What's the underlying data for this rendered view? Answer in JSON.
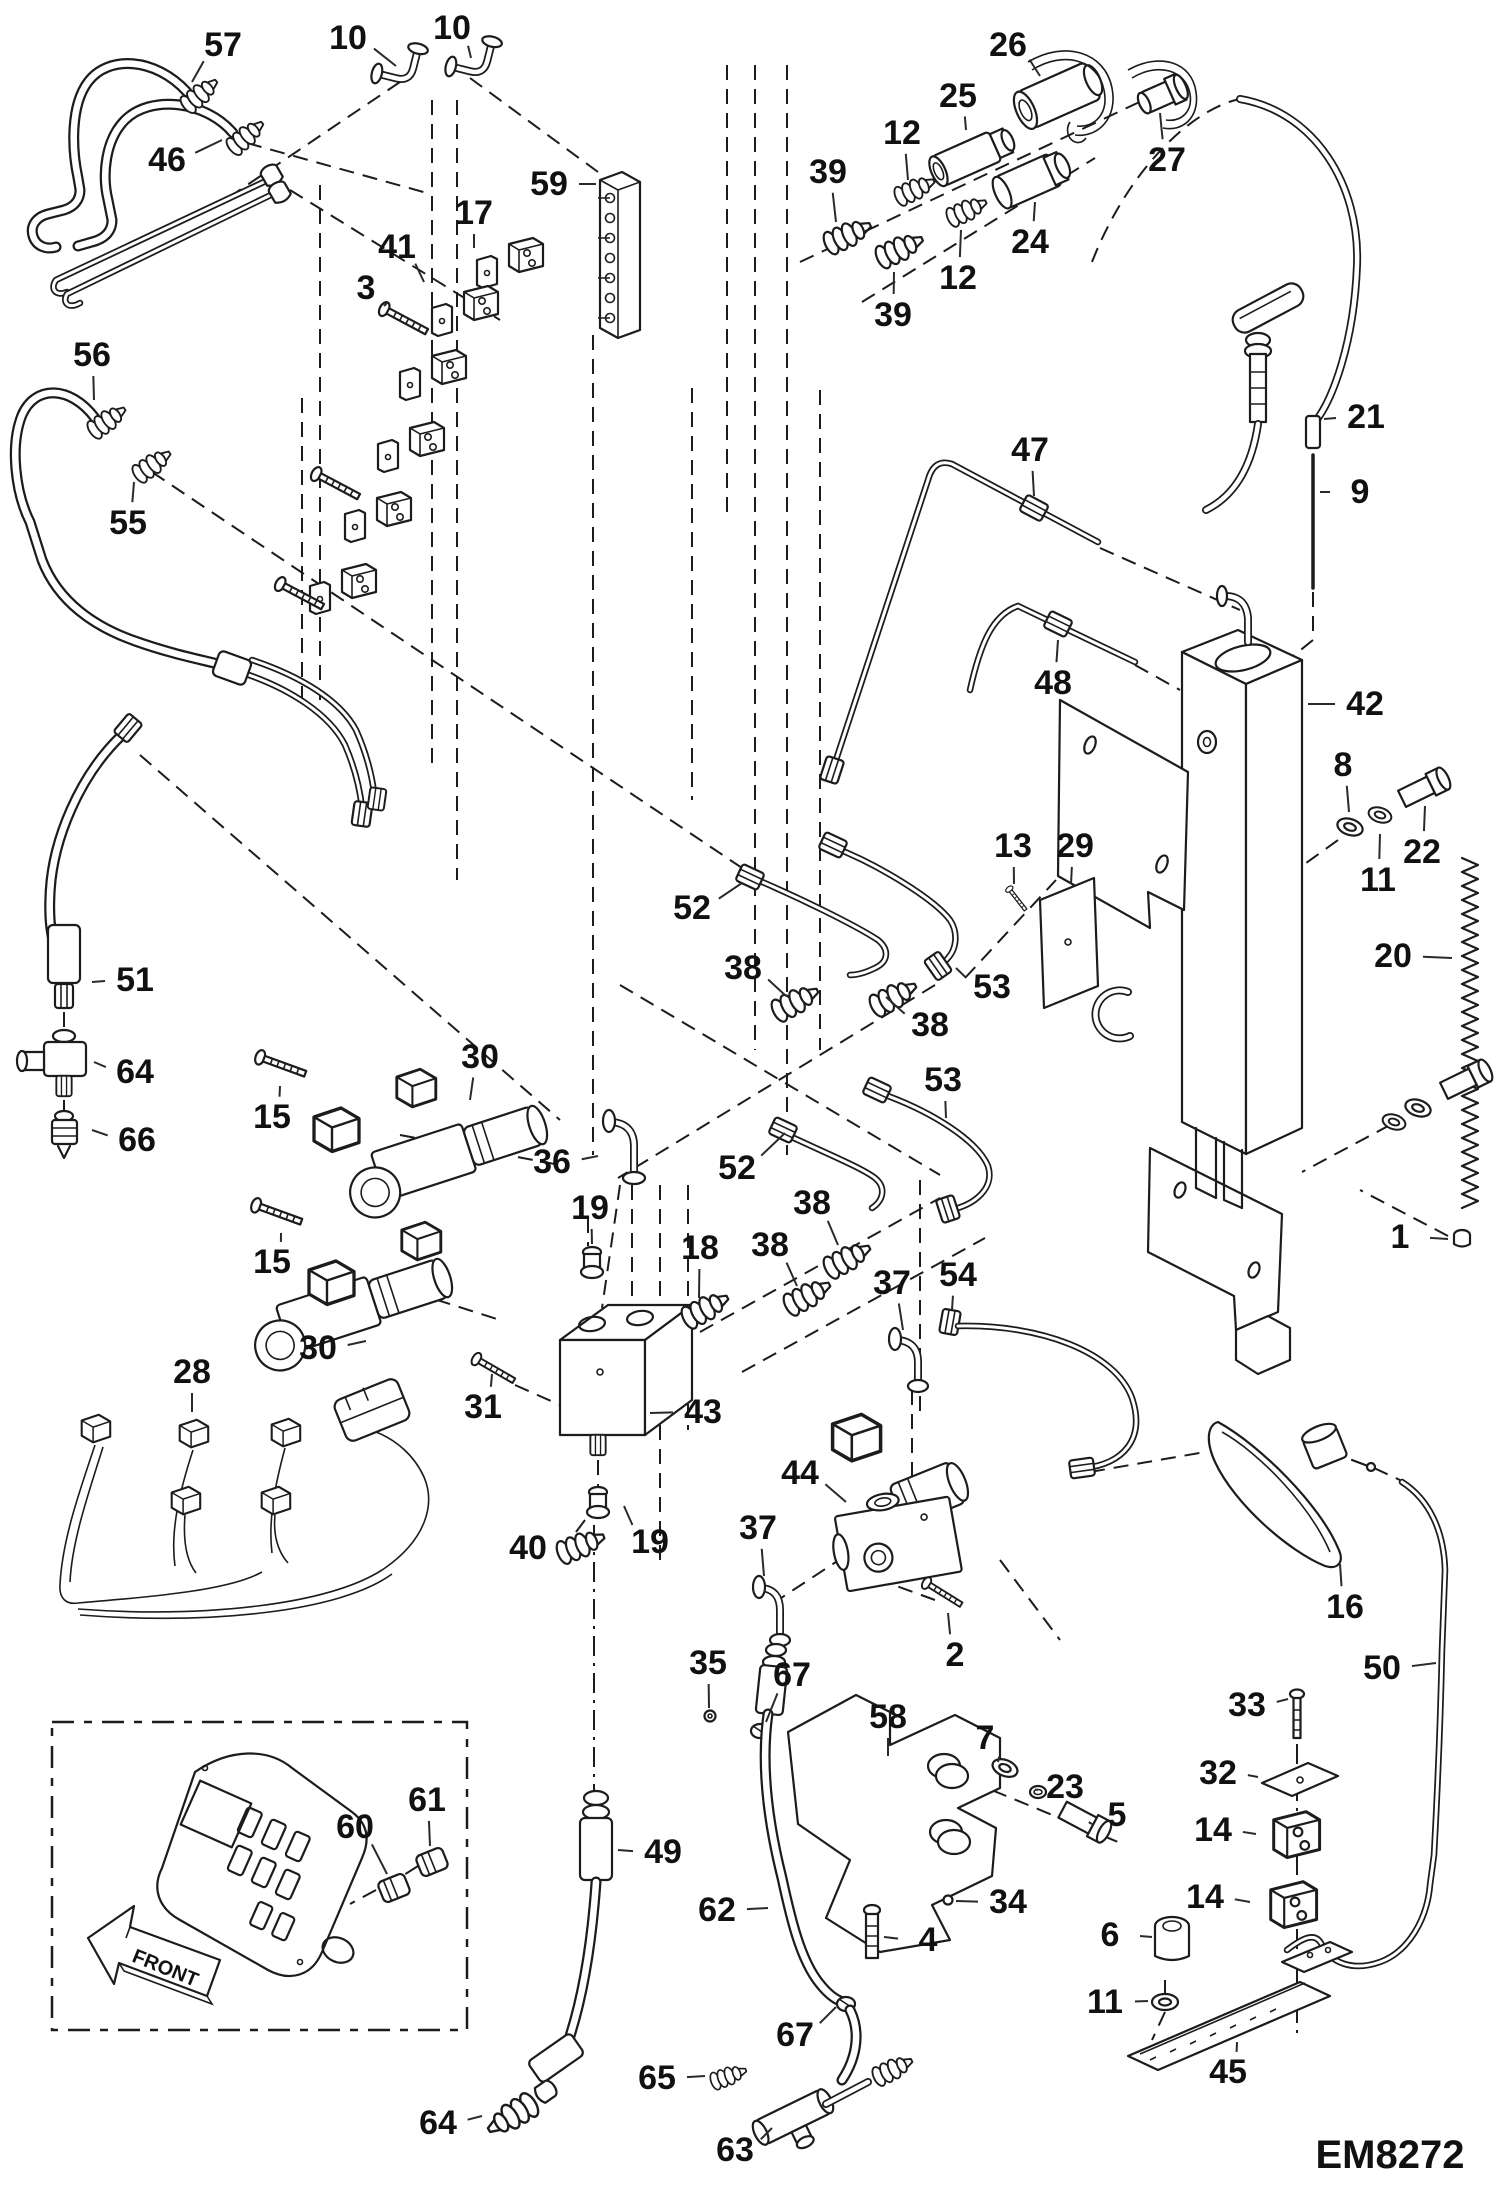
{
  "diagram": {
    "code": "EM8272",
    "front_label": "FRONT",
    "type": "exploded-parts-diagram",
    "callouts": [
      {
        "label": "57",
        "x": 223,
        "y": 45,
        "t": [
          192,
          82
        ]
      },
      {
        "label": "10",
        "x": 348,
        "y": 38,
        "t": [
          396,
          66
        ]
      },
      {
        "label": "10",
        "x": 452,
        "y": 28,
        "t": [
          471,
          58
        ]
      },
      {
        "label": "46",
        "x": 167,
        "y": 160,
        "t": [
          222,
          140
        ]
      },
      {
        "label": "26",
        "x": 1008,
        "y": 45,
        "t": [
          1040,
          76
        ]
      },
      {
        "label": "25",
        "x": 958,
        "y": 96,
        "t": [
          966,
          130
        ]
      },
      {
        "label": "12",
        "x": 902,
        "y": 133,
        "t": [
          908,
          180
        ]
      },
      {
        "label": "39",
        "x": 828,
        "y": 172,
        "t": [
          836,
          222
        ]
      },
      {
        "label": "27",
        "x": 1167,
        "y": 160,
        "t": [
          1160,
          113
        ]
      },
      {
        "label": "24",
        "x": 1030,
        "y": 242,
        "t": [
          1035,
          202
        ]
      },
      {
        "label": "12",
        "x": 958,
        "y": 278,
        "t": [
          961,
          230
        ]
      },
      {
        "label": "39",
        "x": 893,
        "y": 315,
        "t": [
          894,
          272
        ]
      },
      {
        "label": "59",
        "x": 549,
        "y": 184,
        "t": [
          596,
          184
        ]
      },
      {
        "label": "17",
        "x": 474,
        "y": 213,
        "t": [
          474,
          248
        ]
      },
      {
        "label": "41",
        "x": 397,
        "y": 247,
        "t": [
          424,
          282
        ]
      },
      {
        "label": "3",
        "x": 366,
        "y": 288,
        "t": [
          384,
          306
        ]
      },
      {
        "label": "56",
        "x": 92,
        "y": 355,
        "t": [
          94,
          400
        ]
      },
      {
        "label": "55",
        "x": 128,
        "y": 523,
        "t": [
          134,
          482
        ]
      },
      {
        "label": "21",
        "x": 1366,
        "y": 417,
        "t": [
          1324,
          419
        ]
      },
      {
        "label": "9",
        "x": 1360,
        "y": 492,
        "t": [
          1320,
          492
        ]
      },
      {
        "label": "47",
        "x": 1030,
        "y": 450,
        "t": [
          1034,
          496
        ]
      },
      {
        "label": "48",
        "x": 1053,
        "y": 683,
        "t": [
          1058,
          640
        ]
      },
      {
        "label": "42",
        "x": 1365,
        "y": 704,
        "t": [
          1308,
          704
        ]
      },
      {
        "label": "8",
        "x": 1343,
        "y": 765,
        "t": [
          1349,
          812
        ]
      },
      {
        "label": "22",
        "x": 1422,
        "y": 852,
        "t": [
          1425,
          806
        ]
      },
      {
        "label": "11",
        "x": 1378,
        "y": 880,
        "t": [
          1380,
          834
        ]
      },
      {
        "label": "13",
        "x": 1013,
        "y": 846,
        "t": [
          1014,
          884
        ]
      },
      {
        "label": "29",
        "x": 1075,
        "y": 846,
        "t": [
          1071,
          884
        ]
      },
      {
        "label": "20",
        "x": 1393,
        "y": 956,
        "t": [
          1452,
          958
        ]
      },
      {
        "label": "52",
        "x": 692,
        "y": 908,
        "t": [
          742,
          883
        ]
      },
      {
        "label": "38",
        "x": 743,
        "y": 968,
        "t": [
          786,
          996
        ]
      },
      {
        "label": "53",
        "x": 992,
        "y": 987,
        "t": [
          956,
          968
        ]
      },
      {
        "label": "38",
        "x": 930,
        "y": 1025,
        "t": [
          886,
          997
        ]
      },
      {
        "label": "53",
        "x": 943,
        "y": 1080,
        "t": [
          946,
          1118
        ]
      },
      {
        "label": "52",
        "x": 737,
        "y": 1168,
        "t": [
          785,
          1133
        ]
      },
      {
        "label": "51",
        "x": 135,
        "y": 980,
        "t": [
          92,
          982
        ]
      },
      {
        "label": "64",
        "x": 135,
        "y": 1072,
        "t": [
          94,
          1062
        ]
      },
      {
        "label": "66",
        "x": 137,
        "y": 1140,
        "t": [
          92,
          1130
        ]
      },
      {
        "label": "15",
        "x": 272,
        "y": 1117,
        "t": [
          280,
          1086
        ]
      },
      {
        "label": "30",
        "x": 480,
        "y": 1057,
        "t": [
          470,
          1100
        ]
      },
      {
        "label": "36",
        "x": 552,
        "y": 1162,
        "t": [
          598,
          1156
        ]
      },
      {
        "label": "19",
        "x": 590,
        "y": 1208,
        "t": [
          592,
          1244
        ]
      },
      {
        "label": "15",
        "x": 272,
        "y": 1262,
        "t": [
          281,
          1233
        ]
      },
      {
        "label": "30",
        "x": 318,
        "y": 1348,
        "t": [
          366,
          1341
        ]
      },
      {
        "label": "31",
        "x": 483,
        "y": 1407,
        "t": [
          492,
          1374
        ]
      },
      {
        "label": "28",
        "x": 192,
        "y": 1372,
        "t": [
          192,
          1412
        ]
      },
      {
        "label": "18",
        "x": 700,
        "y": 1248,
        "t": [
          699,
          1298
        ]
      },
      {
        "label": "38",
        "x": 812,
        "y": 1203,
        "t": [
          838,
          1245
        ]
      },
      {
        "label": "38",
        "x": 770,
        "y": 1245,
        "t": [
          797,
          1286
        ]
      },
      {
        "label": "37",
        "x": 892,
        "y": 1283,
        "t": [
          903,
          1330
        ]
      },
      {
        "label": "54",
        "x": 958,
        "y": 1275,
        "t": [
          952,
          1310
        ]
      },
      {
        "label": "43",
        "x": 703,
        "y": 1412,
        "t": [
          650,
          1413
        ]
      },
      {
        "label": "44",
        "x": 800,
        "y": 1473,
        "t": [
          846,
          1502
        ]
      },
      {
        "label": "19",
        "x": 650,
        "y": 1542,
        "t": [
          624,
          1506
        ]
      },
      {
        "label": "37",
        "x": 758,
        "y": 1528,
        "t": [
          764,
          1576
        ]
      },
      {
        "label": "40",
        "x": 528,
        "y": 1548,
        "t": [
          556,
          1546
        ]
      },
      {
        "label": "2",
        "x": 955,
        "y": 1655,
        "t": [
          948,
          1613
        ]
      },
      {
        "label": "16",
        "x": 1345,
        "y": 1607,
        "t": [
          1340,
          1564
        ]
      },
      {
        "label": "50",
        "x": 1382,
        "y": 1668,
        "t": [
          1436,
          1663
        ]
      },
      {
        "label": "33",
        "x": 1247,
        "y": 1705,
        "t": [
          1288,
          1699
        ]
      },
      {
        "label": "32",
        "x": 1218,
        "y": 1773,
        "t": [
          1258,
          1777
        ]
      },
      {
        "label": "14",
        "x": 1213,
        "y": 1830,
        "t": [
          1256,
          1834
        ]
      },
      {
        "label": "14",
        "x": 1205,
        "y": 1897,
        "t": [
          1250,
          1902
        ]
      },
      {
        "label": "35",
        "x": 708,
        "y": 1663,
        "t": [
          709,
          1708
        ]
      },
      {
        "label": "67",
        "x": 792,
        "y": 1675,
        "t": [
          766,
          1722
        ]
      },
      {
        "label": "58",
        "x": 888,
        "y": 1717,
        "t": [
          888,
          1756
        ]
      },
      {
        "label": "7",
        "x": 985,
        "y": 1738,
        "t": [
          998,
          1762
        ]
      },
      {
        "label": "23",
        "x": 1065,
        "y": 1787,
        "t": [
          1038,
          1790
        ]
      },
      {
        "label": "5",
        "x": 1117,
        "y": 1815,
        "t": [
          1092,
          1824
        ]
      },
      {
        "label": "34",
        "x": 1008,
        "y": 1902,
        "t": [
          956,
          1901
        ]
      },
      {
        "label": "49",
        "x": 663,
        "y": 1852,
        "t": [
          618,
          1850
        ]
      },
      {
        "label": "62",
        "x": 717,
        "y": 1910,
        "t": [
          768,
          1908
        ]
      },
      {
        "label": "4",
        "x": 928,
        "y": 1940,
        "t": [
          884,
          1937
        ]
      },
      {
        "label": "6",
        "x": 1110,
        "y": 1935,
        "t": [
          1152,
          1937
        ]
      },
      {
        "label": "11",
        "x": 1105,
        "y": 2002,
        "t": [
          1148,
          2001
        ]
      },
      {
        "label": "45",
        "x": 1228,
        "y": 2072,
        "t": [
          1237,
          2042
        ]
      },
      {
        "label": "60",
        "x": 355,
        "y": 1827,
        "t": [
          387,
          1874
        ]
      },
      {
        "label": "61",
        "x": 427,
        "y": 1800,
        "t": [
          430,
          1846
        ]
      },
      {
        "label": "67",
        "x": 795,
        "y": 2035,
        "t": [
          836,
          2007
        ]
      },
      {
        "label": "65",
        "x": 657,
        "y": 2078,
        "t": [
          705,
          2076
        ]
      },
      {
        "label": "64",
        "x": 438,
        "y": 2123,
        "t": [
          482,
          2116
        ]
      },
      {
        "label": "63",
        "x": 735,
        "y": 2150,
        "t": [
          772,
          2128
        ]
      },
      {
        "label": "1",
        "x": 1400,
        "y": 1237,
        "t": [
          1448,
          1239
        ]
      }
    ]
  }
}
